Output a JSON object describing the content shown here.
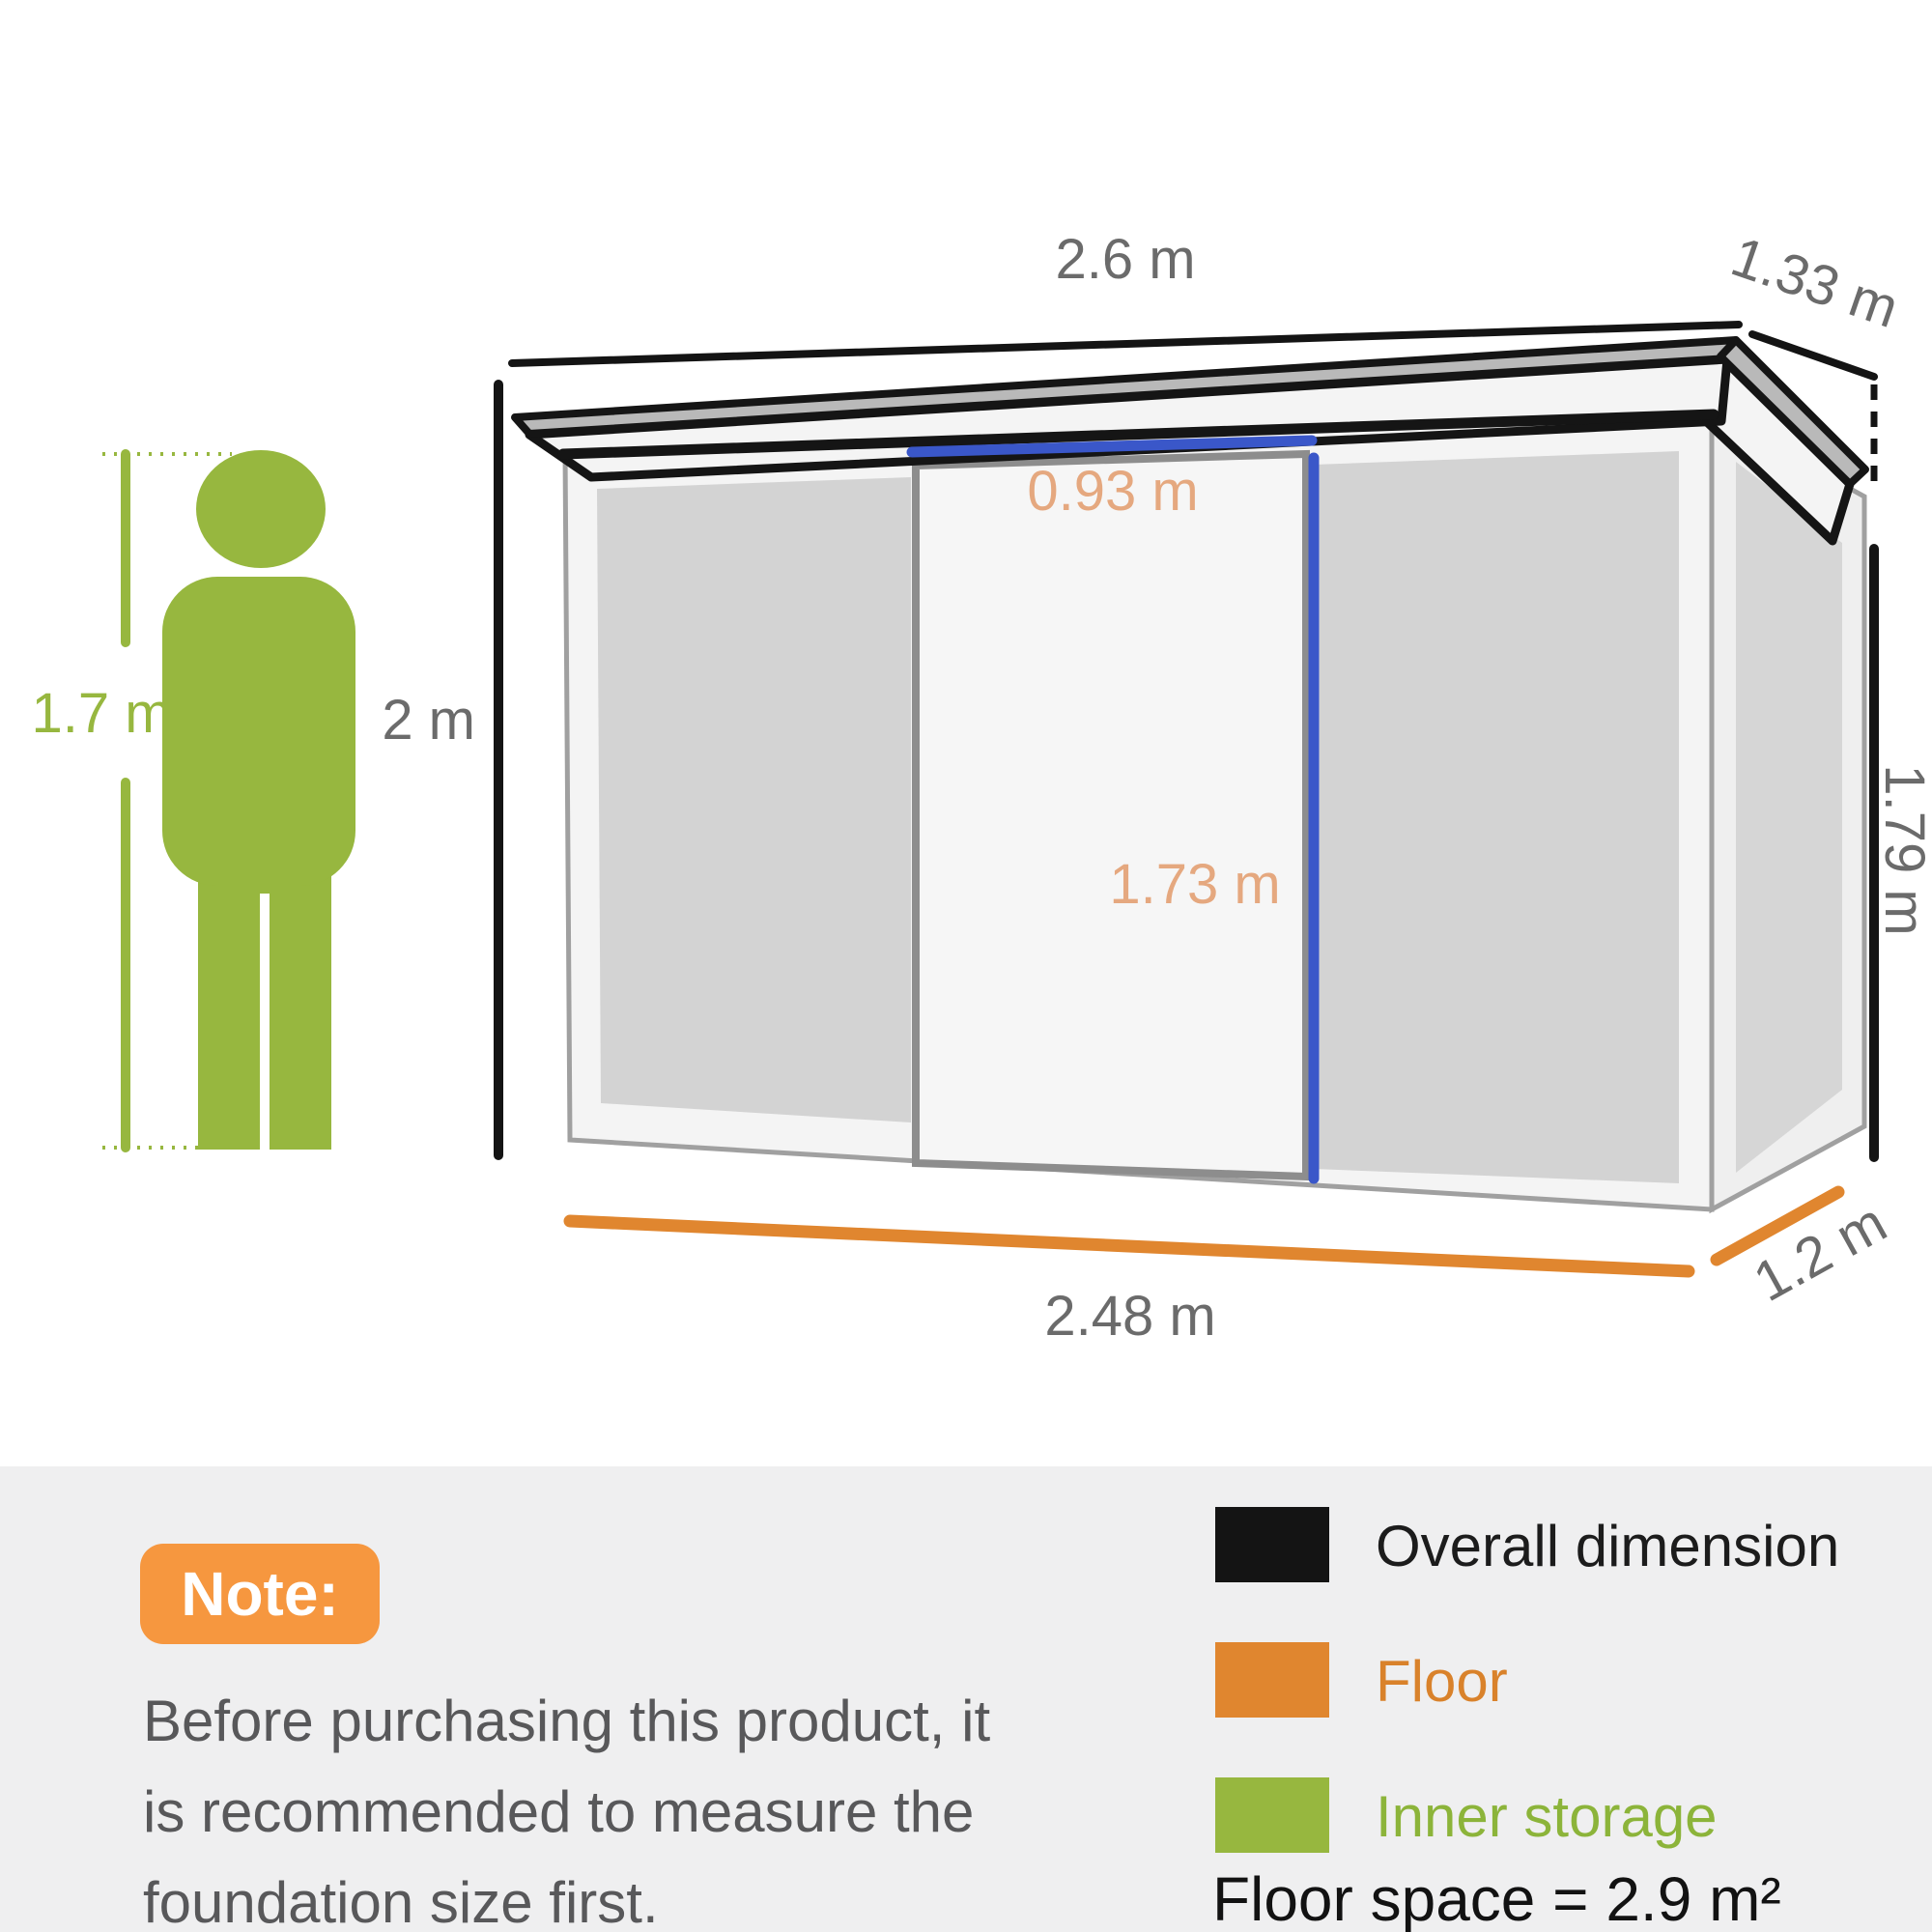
{
  "dimensions": {
    "roof_width": "2.6 m",
    "roof_depth": "1.33 m",
    "overall_height": "2 m",
    "wall_height": "1.79 m",
    "person_height": "1.7 m",
    "door_width": "0.93 m",
    "door_height": "1.73 m",
    "floor_width": "2.48 m",
    "floor_depth": "1.2 m"
  },
  "note": {
    "badge": "Note:",
    "lines": [
      "Before purchasing this product, it",
      "is recommended to measure the",
      "foundation size first."
    ]
  },
  "legend": {
    "items": [
      {
        "label": "Overall dimension",
        "swatch": "#141414",
        "text_color": "#1c1c1c"
      },
      {
        "label": "Floor",
        "swatch": "#e0862f",
        "text_color": "#d9822b"
      },
      {
        "label": "Inner storage",
        "swatch": "#97b73f",
        "text_color": "#8cb43a"
      }
    ],
    "floor_space": "Floor space = 2.9 m²"
  },
  "colors": {
    "overall_dimension_line": "#141414",
    "floor_line": "#e0862f",
    "inner_storage_green": "#97b73f",
    "door_dimension_text": "#e5a87f",
    "inner_width_blue_line": "#3a57c9",
    "dimension_text_gray": "#6b6b6b",
    "note_badge_orange": "#f6973f",
    "note_text_gray": "#58585a",
    "band_background": "#efeff0"
  }
}
